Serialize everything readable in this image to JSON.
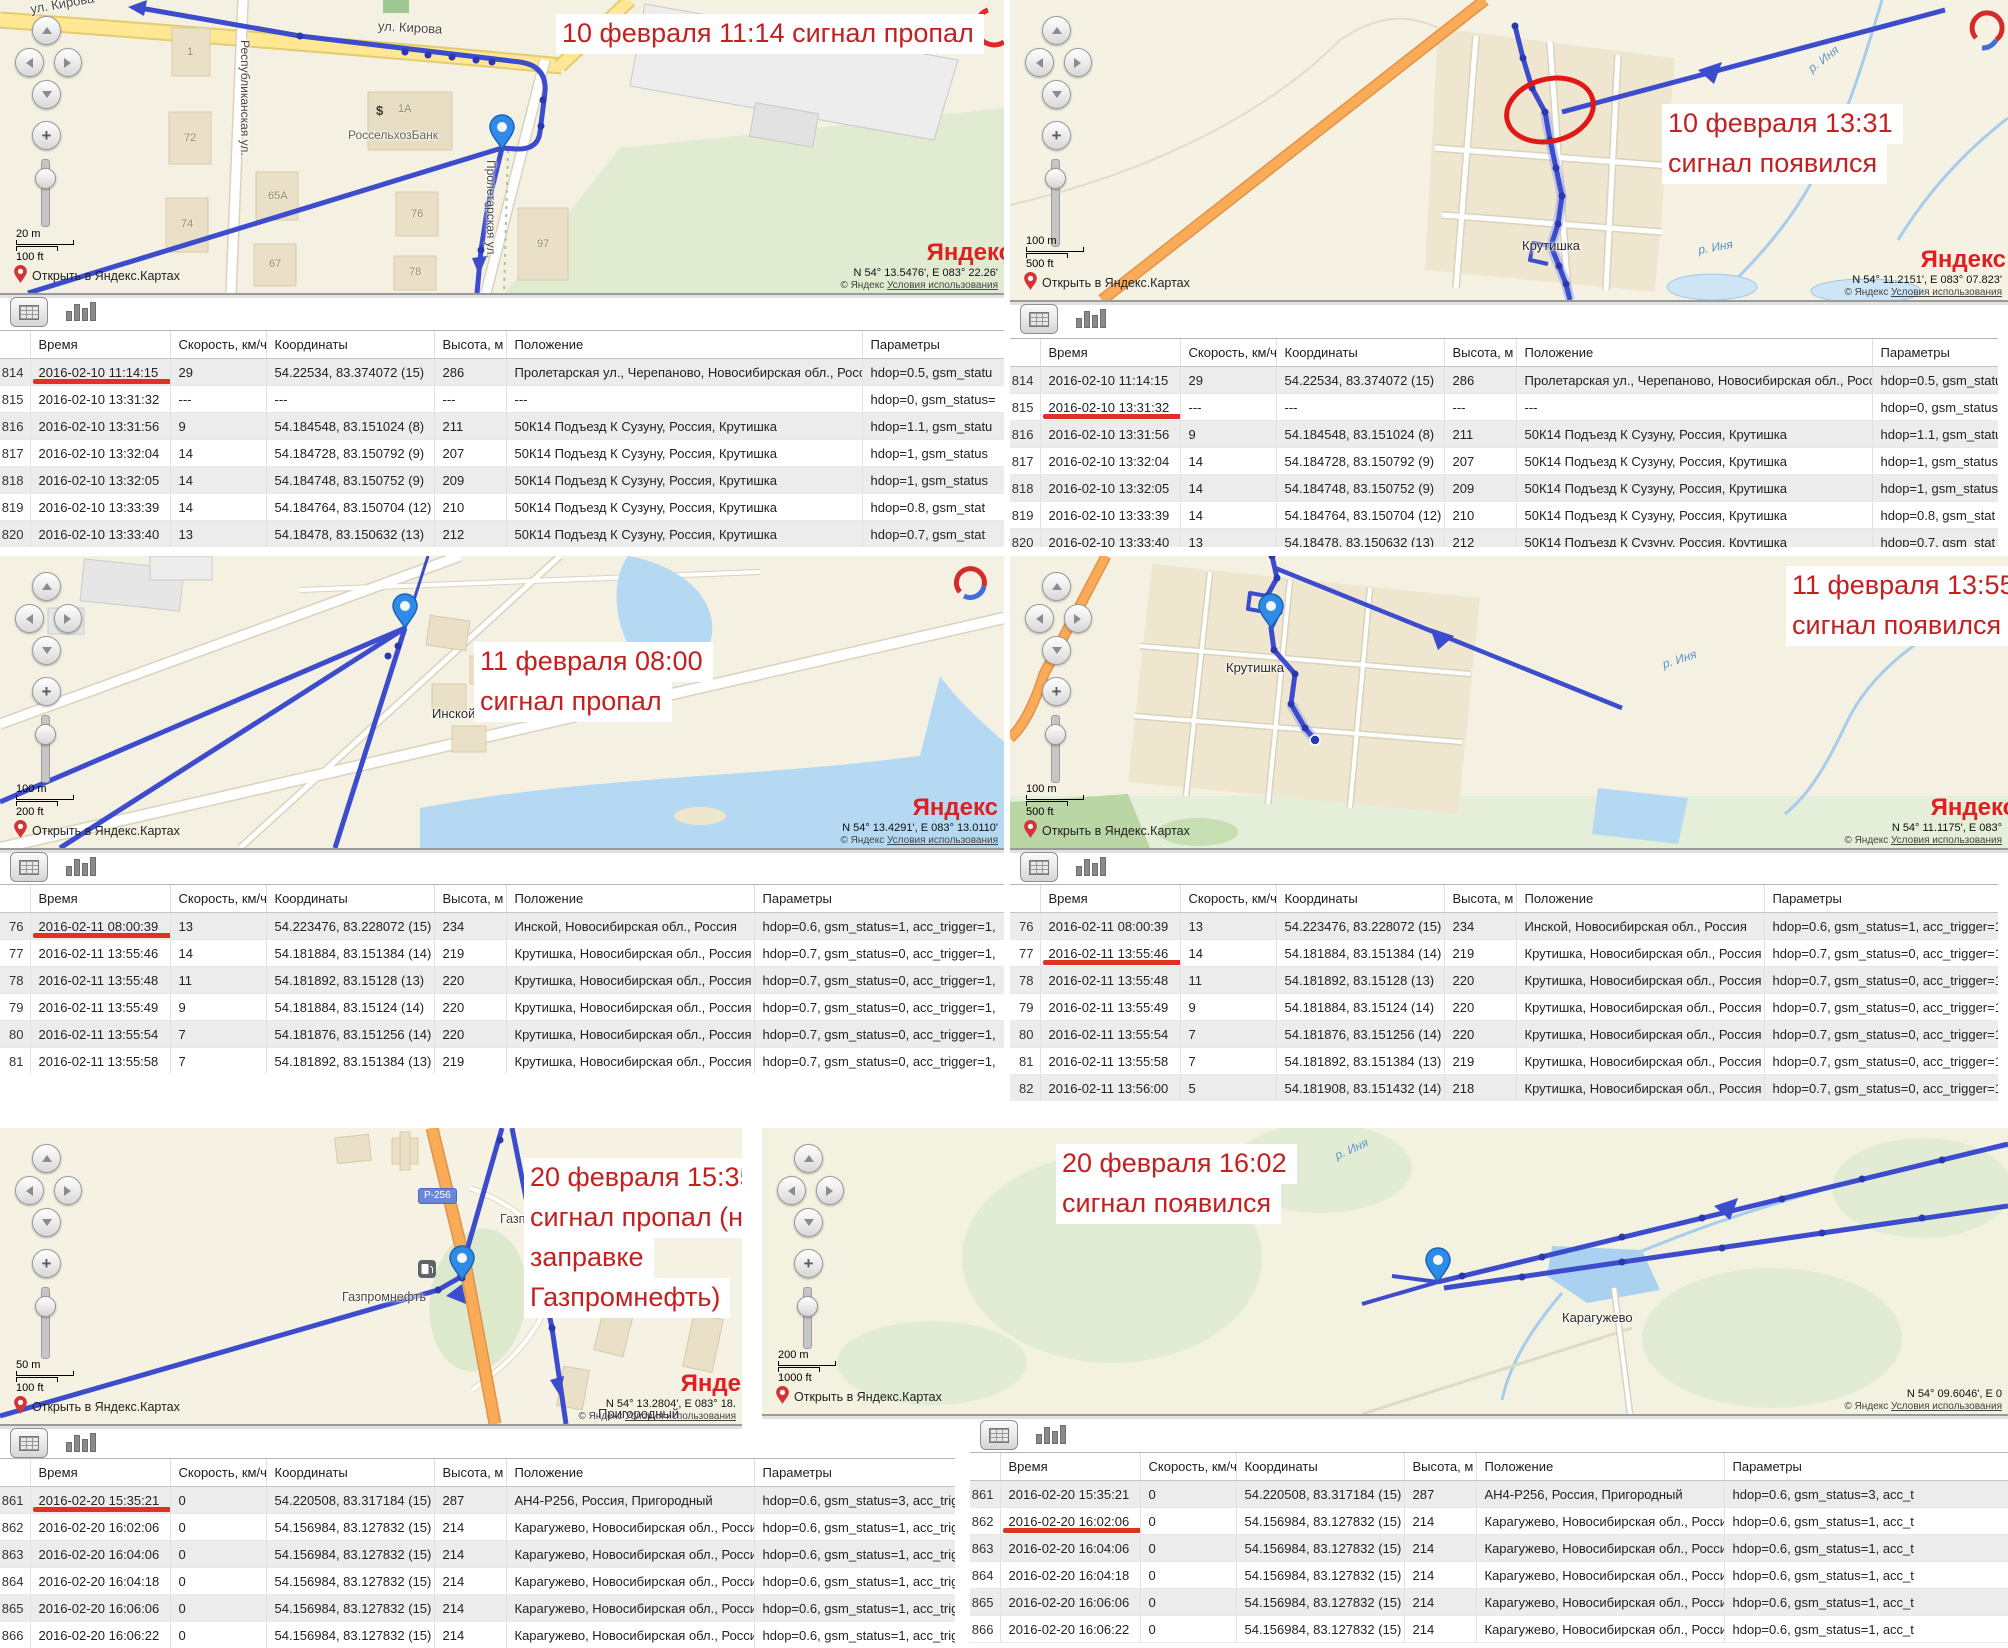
{
  "ui": {
    "open_link": "Открыть в Яндекс.Картах",
    "logo": "Яндекс",
    "copyright": "© Яндекс",
    "terms": "Условия использования",
    "columns": [
      "Время",
      "Скорость, км/ч",
      "Координаты",
      "Высота, м",
      "Положение",
      "Параметры"
    ]
  },
  "panels": {
    "p1": {
      "annotation": [
        "10 февраля 11:14 сигнал пропал"
      ],
      "scale": [
        "20 m",
        "100 ft"
      ],
      "coords": "N 54° 13.5476', E 083° 22.26'",
      "labels": {
        "kirova": "ул. Кирова",
        "kirova_top": "ул. Кирова",
        "respublikanskaya": "Республиканская ул.",
        "proletarskaya": "Пролетарская ул.",
        "bank": "РоссельхозБанк",
        "bank_sign": "$"
      },
      "houses": [
        "1",
        "72",
        "74",
        "65А",
        "67",
        "76",
        "78",
        "97",
        "1А"
      ],
      "table": {
        "underline_row": 0,
        "underline_w": 150,
        "rows": [
          [
            "814",
            "2016-02-10 11:14:15",
            "29",
            "54.22534, 83.374072 (15)",
            "286",
            "Пролетарская ул., Черепаново, Новосибирская обл., Россия",
            "hdop=0.5, gsm_statu"
          ],
          [
            "815",
            "2016-02-10 13:31:32",
            "---",
            "---",
            "---",
            "---",
            "hdop=0, gsm_status="
          ],
          [
            "816",
            "2016-02-10 13:31:56",
            "9",
            "54.184548, 83.151024 (8)",
            "211",
            "50К14 Подъезд К Сузуну, Россия, Крутишка",
            "hdop=1.1, gsm_statu"
          ],
          [
            "817",
            "2016-02-10 13:32:04",
            "14",
            "54.184728, 83.150792 (9)",
            "207",
            "50К14 Подъезд К Сузуну, Россия, Крутишка",
            "hdop=1, gsm_status"
          ],
          [
            "818",
            "2016-02-10 13:32:05",
            "14",
            "54.184748, 83.150752 (9)",
            "209",
            "50К14 Подъезд К Сузуну, Россия, Крутишка",
            "hdop=1, gsm_status"
          ],
          [
            "819",
            "2016-02-10 13:33:39",
            "14",
            "54.184764, 83.150704 (12)",
            "210",
            "50К14 Подъезд К Сузуну, Россия, Крутишка",
            "hdop=0.8, gsm_stat"
          ],
          [
            "820",
            "2016-02-10 13:33:40",
            "13",
            "54.18478, 83.150632 (13)",
            "212",
            "50К14 Подъезд К Сузуну, Россия, Крутишка",
            "hdop=0.7, gsm_stat"
          ]
        ]
      }
    },
    "p2": {
      "annotation": [
        "10 февраля 13:31",
        "сигнал появился"
      ],
      "scale": [
        "100 m",
        "500 ft"
      ],
      "coords": "N 54° 11.2151', E 083° 07.823'",
      "labels": {
        "krutishka": "Крутишка",
        "inya_a": "р. Иня",
        "inya_b": "р. Иня"
      },
      "table": {
        "underline_row": 1,
        "underline_w": 190,
        "rows": [
          [
            "814",
            "2016-02-10 11:14:15",
            "29",
            "54.22534, 83.374072 (15)",
            "286",
            "Пролетарская ул., Черепаново, Новосибирская обл., Россия",
            "hdop=0.5, gsm_statu"
          ],
          [
            "815",
            "2016-02-10 13:31:32",
            "---",
            "---",
            "---",
            "---",
            "hdop=0, gsm_status="
          ],
          [
            "816",
            "2016-02-10 13:31:56",
            "9",
            "54.184548, 83.151024 (8)",
            "211",
            "50К14 Подъезд К Сузуну, Россия, Крутишка",
            "hdop=1.1, gsm_statu"
          ],
          [
            "817",
            "2016-02-10 13:32:04",
            "14",
            "54.184728, 83.150792 (9)",
            "207",
            "50К14 Подъезд К Сузуну, Россия, Крутишка",
            "hdop=1, gsm_status"
          ],
          [
            "818",
            "2016-02-10 13:32:05",
            "14",
            "54.184748, 83.150752 (9)",
            "209",
            "50К14 Подъезд К Сузуну, Россия, Крутишка",
            "hdop=1, gsm_status"
          ],
          [
            "819",
            "2016-02-10 13:33:39",
            "14",
            "54.184764, 83.150704 (12)",
            "210",
            "50К14 Подъезд К Сузуну, Россия, Крутишка",
            "hdop=0.8, gsm_stat"
          ],
          [
            "820",
            "2016-02-10 13:33:40",
            "13",
            "54.18478, 83.150632 (13)",
            "212",
            "50К14 Подъезд К Сузуну, Россия, Крутишка",
            "hdop=0.7, gsm_stat"
          ]
        ]
      }
    },
    "p3": {
      "annotation": [
        "11 февраля 08:00",
        "сигнал пропал"
      ],
      "scale": [
        "100 m",
        "200 ft"
      ],
      "coords": "N 54° 13.4291', E 083° 13.0110'",
      "labels": {
        "inskoy": "Инской"
      },
      "table": {
        "underline_row": 0,
        "underline_w": 215,
        "rows": [
          [
            "76",
            "2016-02-11 08:00:39",
            "13",
            "54.223476, 83.228072 (15)",
            "234",
            "Инской, Новосибирская обл., Россия",
            "hdop=0.6, gsm_status=1, acc_trigger=1,"
          ],
          [
            "77",
            "2016-02-11 13:55:46",
            "14",
            "54.181884, 83.151384 (14)",
            "219",
            "Крутишка, Новосибирская обл., Россия",
            "hdop=0.7, gsm_status=0, acc_trigger=1,"
          ],
          [
            "78",
            "2016-02-11 13:55:48",
            "11",
            "54.181892, 83.15128 (13)",
            "220",
            "Крутишка, Новосибирская обл., Россия",
            "hdop=0.7, gsm_status=0, acc_trigger=1,"
          ],
          [
            "79",
            "2016-02-11 13:55:49",
            "9",
            "54.181884, 83.15124 (14)",
            "220",
            "Крутишка, Новосибирская обл., Россия",
            "hdop=0.7, gsm_status=0, acc_trigger=1,"
          ],
          [
            "80",
            "2016-02-11 13:55:54",
            "7",
            "54.181876, 83.151256 (14)",
            "220",
            "Крутишка, Новосибирская обл., Россия",
            "hdop=0.7, gsm_status=0, acc_trigger=1,"
          ],
          [
            "81",
            "2016-02-11 13:55:58",
            "7",
            "54.181892, 83.151384 (13)",
            "219",
            "Крутишка, Новосибирская обл., Россия",
            "hdop=0.7, gsm_status=0, acc_trigger=1,"
          ]
        ]
      }
    },
    "p4": {
      "annotation": [
        "11 февраля 13:55",
        "сигнал появился"
      ],
      "scale": [
        "100 m",
        "500 ft"
      ],
      "coords": "N 54° 11.1175', E 083°",
      "labels": {
        "krutishka": "Крутишка",
        "inya": "р. Иня"
      },
      "table": {
        "underline_row": 1,
        "underline_w": 260,
        "rows": [
          [
            "76",
            "2016-02-11 08:00:39",
            "13",
            "54.223476, 83.228072 (15)",
            "234",
            "Инской, Новосибирская обл., Россия",
            "hdop=0.6, gsm_status=1, acc_trigger=1,"
          ],
          [
            "77",
            "2016-02-11 13:55:46",
            "14",
            "54.181884, 83.151384 (14)",
            "219",
            "Крутишка, Новосибирская обл., Россия",
            "hdop=0.7, gsm_status=0, acc_trigger=1,"
          ],
          [
            "78",
            "2016-02-11 13:55:48",
            "11",
            "54.181892, 83.15128 (13)",
            "220",
            "Крутишка, Новосибирская обл., Россия",
            "hdop=0.7, gsm_status=0, acc_trigger=1,"
          ],
          [
            "79",
            "2016-02-11 13:55:49",
            "9",
            "54.181884, 83.15124 (14)",
            "220",
            "Крутишка, Новосибирская обл., Россия",
            "hdop=0.7, gsm_status=0, acc_trigger=1,"
          ],
          [
            "80",
            "2016-02-11 13:55:54",
            "7",
            "54.181876, 83.151256 (14)",
            "220",
            "Крутишка, Новосибирская обл., Россия",
            "hdop=0.7, gsm_status=0, acc_trigger=1,"
          ],
          [
            "81",
            "2016-02-11 13:55:58",
            "7",
            "54.181892, 83.151384 (13)",
            "219",
            "Крутишка, Новосибирская обл., Россия",
            "hdop=0.7, gsm_status=0, acc_trigger=1,"
          ],
          [
            "82",
            "2016-02-11 13:56:00",
            "5",
            "54.181908, 83.151432 (14)",
            "218",
            "Крутишка, Новосибирская обл., Россия",
            "hdop=0.7, gsm_status=0, acc_trigger=1,"
          ]
        ]
      }
    },
    "p5": {
      "annotation": [
        "20 февраля 15:35",
        "сигнал пропал (на",
        "заправке",
        "Газпромнефть)"
      ],
      "scale": [
        "50 m",
        "100 ft"
      ],
      "coords": "N 54° 13.2804', E 083° 18.",
      "labels": {
        "gas_a": "Газпромнефть",
        "gas_b": "Газпромнефть",
        "road_badge": "Р-256",
        "prigorodny": "Пригородный"
      },
      "table": {
        "underline_row": 0,
        "underline_w": 220,
        "rows": [
          [
            "861",
            "2016-02-20 15:35:21",
            "0",
            "54.220508, 83.317184 (15)",
            "287",
            "АН4-Р256, Россия, Пригородный",
            "hdop=0.6, gsm_status=3, acc_trigger="
          ],
          [
            "862",
            "2016-02-20 16:02:06",
            "0",
            "54.156984, 83.127832 (15)",
            "214",
            "Карагужево, Новосибирская обл., Россия",
            "hdop=0.6, gsm_status=1, acc_trigger="
          ],
          [
            "863",
            "2016-02-20 16:04:06",
            "0",
            "54.156984, 83.127832 (15)",
            "214",
            "Карагужево, Новосибирская обл., Россия",
            "hdop=0.6, gsm_status=1, acc_trigger="
          ],
          [
            "864",
            "2016-02-20 16:04:18",
            "0",
            "54.156984, 83.127832 (15)",
            "214",
            "Карагужево, Новосибирская обл., Россия",
            "hdop=0.6, gsm_status=1, acc_trigger="
          ],
          [
            "865",
            "2016-02-20 16:06:06",
            "0",
            "54.156984, 83.127832 (15)",
            "214",
            "Карагужево, Новосибирская обл., Россия",
            "hdop=0.6, gsm_status=1, acc_trigger="
          ],
          [
            "866",
            "2016-02-20 16:06:22",
            "0",
            "54.156984, 83.127832 (15)",
            "214",
            "Карагужево, Новосибирская обл., Россия",
            "hdop=0.6, gsm_status=1, acc_trigger="
          ]
        ]
      }
    },
    "p6": {
      "annotation": [
        "20 февраля 16:02",
        "сигнал появился"
      ],
      "scale": [
        "200 m",
        "1000 ft"
      ],
      "coords": "N 54° 09.6046', E 0",
      "labels": {
        "karaguzhevo": "Карагужево",
        "inya": "р. Иня"
      },
      "table": {
        "underline_row": 1,
        "underline_w": 210,
        "rows": [
          [
            "861",
            "2016-02-20 15:35:21",
            "0",
            "54.220508, 83.317184 (15)",
            "287",
            "АН4-Р256, Россия, Пригородный",
            "hdop=0.6, gsm_status=3, acc_t"
          ],
          [
            "862",
            "2016-02-20 16:02:06",
            "0",
            "54.156984, 83.127832 (15)",
            "214",
            "Карагужево, Новосибирская обл., Россия",
            "hdop=0.6, gsm_status=1, acc_t"
          ],
          [
            "863",
            "2016-02-20 16:04:06",
            "0",
            "54.156984, 83.127832 (15)",
            "214",
            "Карагужево, Новосибирская обл., Россия",
            "hdop=0.6, gsm_status=1, acc_t"
          ],
          [
            "864",
            "2016-02-20 16:04:18",
            "0",
            "54.156984, 83.127832 (15)",
            "214",
            "Карагужево, Новосибирская обл., Россия",
            "hdop=0.6, gsm_status=1, acc_t"
          ],
          [
            "865",
            "2016-02-20 16:06:06",
            "0",
            "54.156984, 83.127832 (15)",
            "214",
            "Карагужево, Новосибирская обл., Россия",
            "hdop=0.6, gsm_status=1, acc_t"
          ],
          [
            "866",
            "2016-02-20 16:06:22",
            "0",
            "54.156984, 83.127832 (15)",
            "214",
            "Карагужево, Новосибирская обл., Россия",
            "hdop=0.6, gsm_status=1, acc_t"
          ]
        ]
      }
    }
  }
}
